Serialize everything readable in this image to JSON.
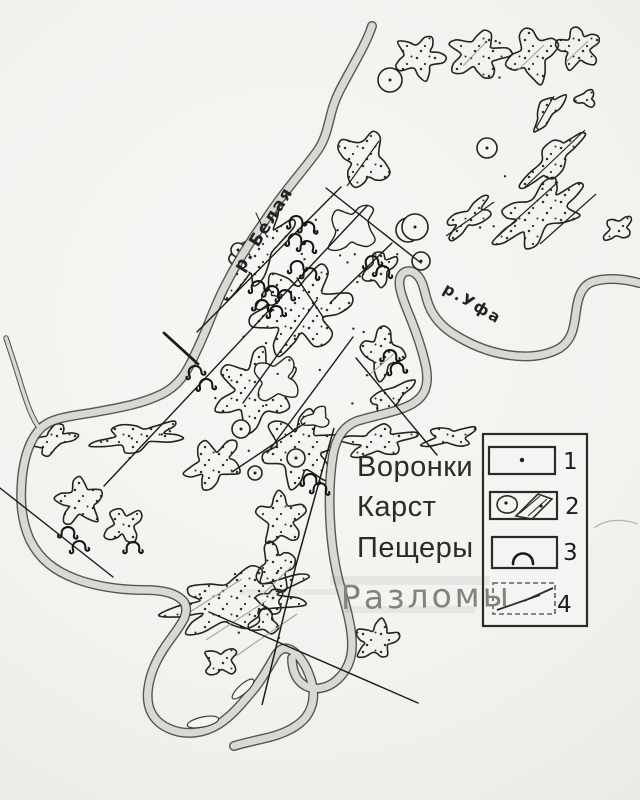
{
  "paper_color": "#f5f4f2",
  "ink_color": "#1c1c1c",
  "river_fill": "#d8d8d4",
  "labels": {
    "features": [
      {
        "text": "Воронки"
      },
      {
        "text": "Карст"
      },
      {
        "text": "Пещеры"
      },
      {
        "text": "Разломы",
        "style": "faded-highlighted"
      }
    ],
    "rivers": [
      {
        "text": "р. Белая"
      },
      {
        "text": "р.Уфа"
      }
    ]
  },
  "legend": {
    "items": [
      {
        "number": "1",
        "symbol": "sinkhole-dot"
      },
      {
        "number": "2",
        "symbol": "karst-area"
      },
      {
        "number": "3",
        "symbol": "cave-entrance-arc"
      },
      {
        "number": "4",
        "symbol": "fault-line"
      }
    ]
  }
}
